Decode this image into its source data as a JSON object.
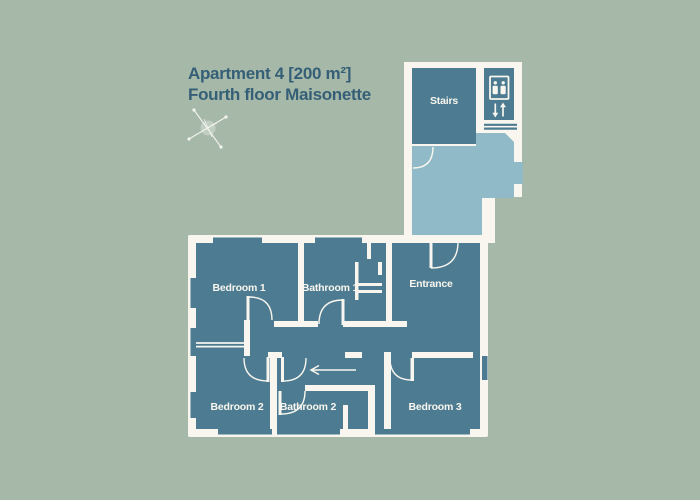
{
  "title": {
    "line1": "Apartment 4 [200 m²]",
    "line2": "Fourth floor Maisonette"
  },
  "plan": {
    "stairs": "Stairs",
    "entrance": "Entrance",
    "bedroom1": "Bedroom 1",
    "bathroom1": "Bathroom 1",
    "bedroom2": "Bedroom 2",
    "bathroom2": "Bathroom 2",
    "bedroom3": "Bedroom 3"
  },
  "icons": {
    "compass": "compass-rose-icon",
    "elevator": "elevator-icon",
    "entry_arrow": "entry-direction-arrow"
  },
  "colors": {
    "background": "#a6b8a8",
    "wall": "#f8f6ee",
    "room": "#4d7b91",
    "landing": "#90bac8",
    "title": "#355f76",
    "label": "#f8f6ee"
  }
}
